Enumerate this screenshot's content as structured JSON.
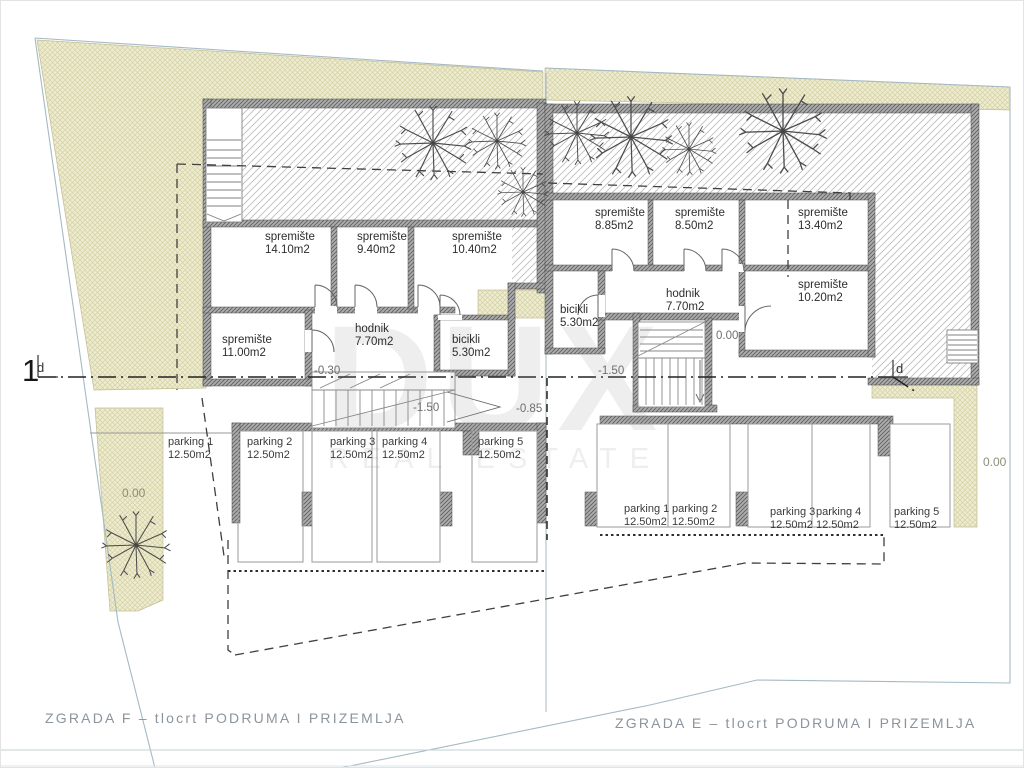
{
  "plan": {
    "watermark": {
      "title": "DUX",
      "subtitle": "REAL ESTATE"
    },
    "titles": {
      "zgrada_f": "ZGRADA F – tlocrt PODRUMA I PRIZEMLJA",
      "zgrada_e": "ZGRADA E – tlocrt PODRUMA I PRIZEMLJA"
    },
    "section_markers": {
      "left_number": "1",
      "left_letter": "d",
      "right_letter": "d"
    },
    "site_levels": {
      "southwest": "0.00",
      "east": "0.00"
    },
    "building_f": {
      "rooms": [
        {
          "name": "spremište",
          "area": "14.10m2"
        },
        {
          "name": "spremište",
          "area": "9.40m2"
        },
        {
          "name": "spremište",
          "area": "10.40m2"
        },
        {
          "name": "spremište",
          "area": "11.00m2"
        },
        {
          "name": "hodnik",
          "area": "7.70m2"
        },
        {
          "name": "bicikli",
          "area": "5.30m2"
        }
      ],
      "levels": {
        "entry": "-0.30",
        "stair": "-1.50",
        "landing": "-0.85"
      },
      "parking": [
        {
          "name": "parking 1",
          "area": "12.50m2"
        },
        {
          "name": "parking 2",
          "area": "12.50m2"
        },
        {
          "name": "parking 3",
          "area": "12.50m2"
        },
        {
          "name": "parking 4",
          "area": "12.50m2"
        },
        {
          "name": "parking 5",
          "area": "12.50m2"
        }
      ]
    },
    "building_e": {
      "rooms": [
        {
          "name": "spremište",
          "area": "8.85m2"
        },
        {
          "name": "spremište",
          "area": "8.50m2"
        },
        {
          "name": "spremište",
          "area": "13.40m2"
        },
        {
          "name": "hodnik",
          "area": "7.70m2"
        },
        {
          "name": "spremište",
          "area": "10.20m2"
        },
        {
          "name": "bicikli",
          "area": "5.30m2"
        }
      ],
      "levels": {
        "ground": "0.00",
        "stair": "-1.50"
      },
      "parking": [
        {
          "name": "parking 1",
          "area": "12.50m2"
        },
        {
          "name": "parking 2",
          "area": "12.50m2"
        },
        {
          "name": "parking 3",
          "area": "12.50m2"
        },
        {
          "name": "parking 4",
          "area": "12.50m2"
        },
        {
          "name": "parking 5",
          "area": "12.50m2"
        }
      ]
    },
    "colors": {
      "terrain_hatch": "#edecd0",
      "garden_hatch_line": "#bdbdbd",
      "wall": "#adadad",
      "boundary_line": "#a5bac4",
      "title_text": "#8c949c"
    }
  }
}
